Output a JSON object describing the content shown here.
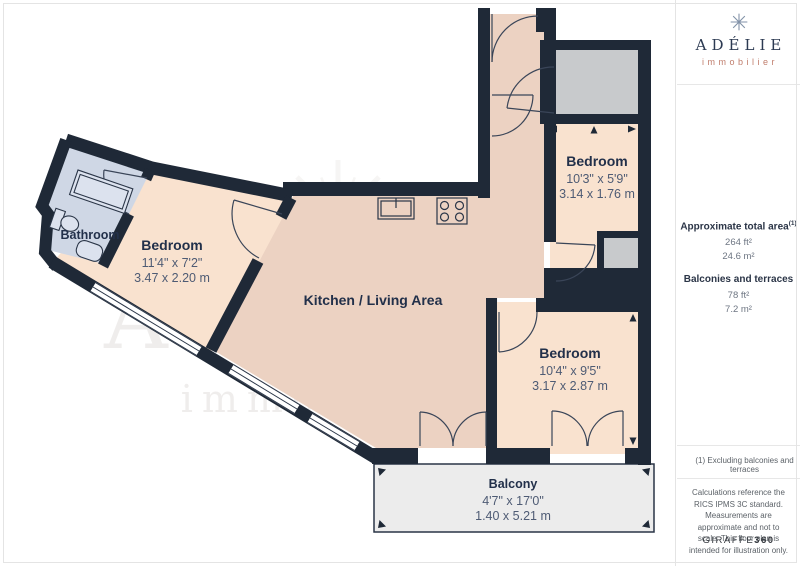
{
  "plan": {
    "rooms": [
      {
        "id": "bathroom",
        "name": "Bathroom",
        "dim_ft": "",
        "dim_m": ""
      },
      {
        "id": "bedroom-1",
        "name": "Bedroom",
        "dim_ft": "11'4\" x 7'2\"",
        "dim_m": "3.47 x 2.20 m"
      },
      {
        "id": "kitchen-living",
        "name": "Kitchen / Living Area",
        "dim_ft": "",
        "dim_m": ""
      },
      {
        "id": "bedroom-2",
        "name": "Bedroom",
        "dim_ft": "10'3\" x 5'9\"",
        "dim_m": "3.14 x 1.76 m"
      },
      {
        "id": "bedroom-3",
        "name": "Bedroom",
        "dim_ft": "10'4\" x 9'5\"",
        "dim_m": "3.17 x 2.87 m"
      },
      {
        "id": "balcony",
        "name": "Balcony",
        "dim_ft": "4'7\" x 17'0\"",
        "dim_m": "1.40 x 5.21 m"
      }
    ],
    "watermark": {
      "line1": "ADÉLIE",
      "line2": "immobilier"
    }
  },
  "sidebar": {
    "logo": {
      "name": "ADÉLIE",
      "tagline": "immobilier"
    },
    "stats": [
      {
        "label": "Approximate total area",
        "sup": "(1)",
        "values": [
          "264 ft²",
          "24.6 m²"
        ]
      },
      {
        "label": "Balconies and terraces",
        "sup": "",
        "values": [
          "78 ft²",
          "7.2 m²"
        ]
      }
    ],
    "note": "(1) Excluding balconies and terraces",
    "disclaimer": "Calculations reference the RICS IPMS 3C standard. Measurements are approximate and not to scale. This floor plan is intended for illustration only.",
    "brand": {
      "name": "GIRAFFE",
      "suffix": "360"
    }
  },
  "colors": {
    "wall": "#1f2937",
    "bedroom": "#f9e2cf",
    "kitchen": "#ecd2c2",
    "bathroom": "#cfd7e5",
    "closet": "#c8cacc",
    "balcony": "#ececec",
    "label": "#22304a",
    "dim_text": "#4e5b74",
    "logo_text": "#2c3a52",
    "logo_accent": "#c07e6d"
  }
}
